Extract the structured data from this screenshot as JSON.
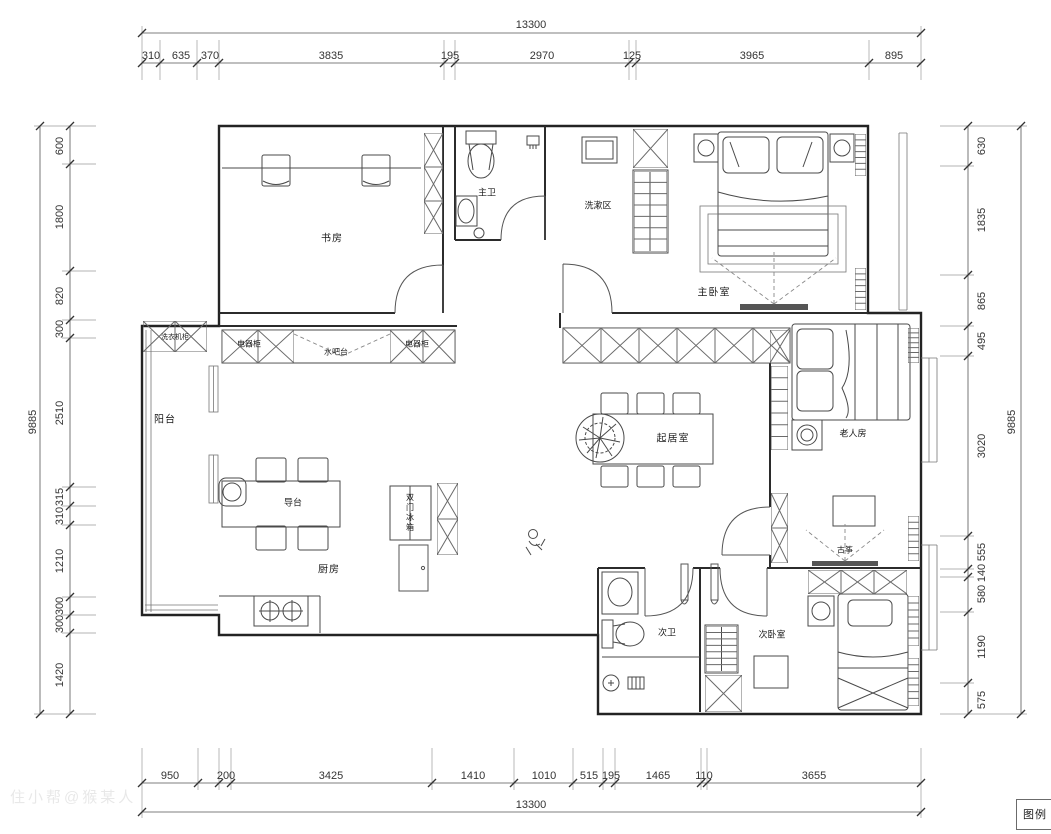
{
  "plan": {
    "watermark": "住小帮@猴某人",
    "legend": "图例"
  },
  "dims": {
    "top_total": "13300",
    "bottom_total": "13300",
    "left_total": "9885",
    "right_total": "9885",
    "top": [
      "310",
      "635",
      "370",
      "3835",
      "195",
      "2970",
      "125",
      "3965",
      "895"
    ],
    "bottom": [
      "950",
      "200",
      "3425",
      "1410",
      "1010",
      "515",
      "195",
      "1465",
      "110",
      "3655"
    ],
    "left": [
      "600",
      "1800",
      "820",
      "300",
      "2510",
      "315",
      "310",
      "1210",
      "300",
      "300",
      "1420"
    ],
    "right": [
      "630",
      "1835",
      "865",
      "495",
      "3020",
      "555",
      "140",
      "580",
      "1190",
      "575"
    ]
  },
  "rooms": {
    "study": "书房",
    "master_bath": "主卫",
    "wash_area": "洗漱区",
    "master_bedroom": "主卧室",
    "balcony": "阳台",
    "laundry_cabinet": "洗衣机柜",
    "appliance_cabinet_l": "电器柜",
    "water_bar": "水吧台",
    "appliance_cabinet_r": "电器柜",
    "island": "导台",
    "kitchen": "厨房",
    "fridge": "双门冰箱",
    "living": "起居室",
    "elder": "老人房",
    "guzheng": "古筝",
    "second_bath": "次卫",
    "second_bedroom": "次卧室"
  }
}
